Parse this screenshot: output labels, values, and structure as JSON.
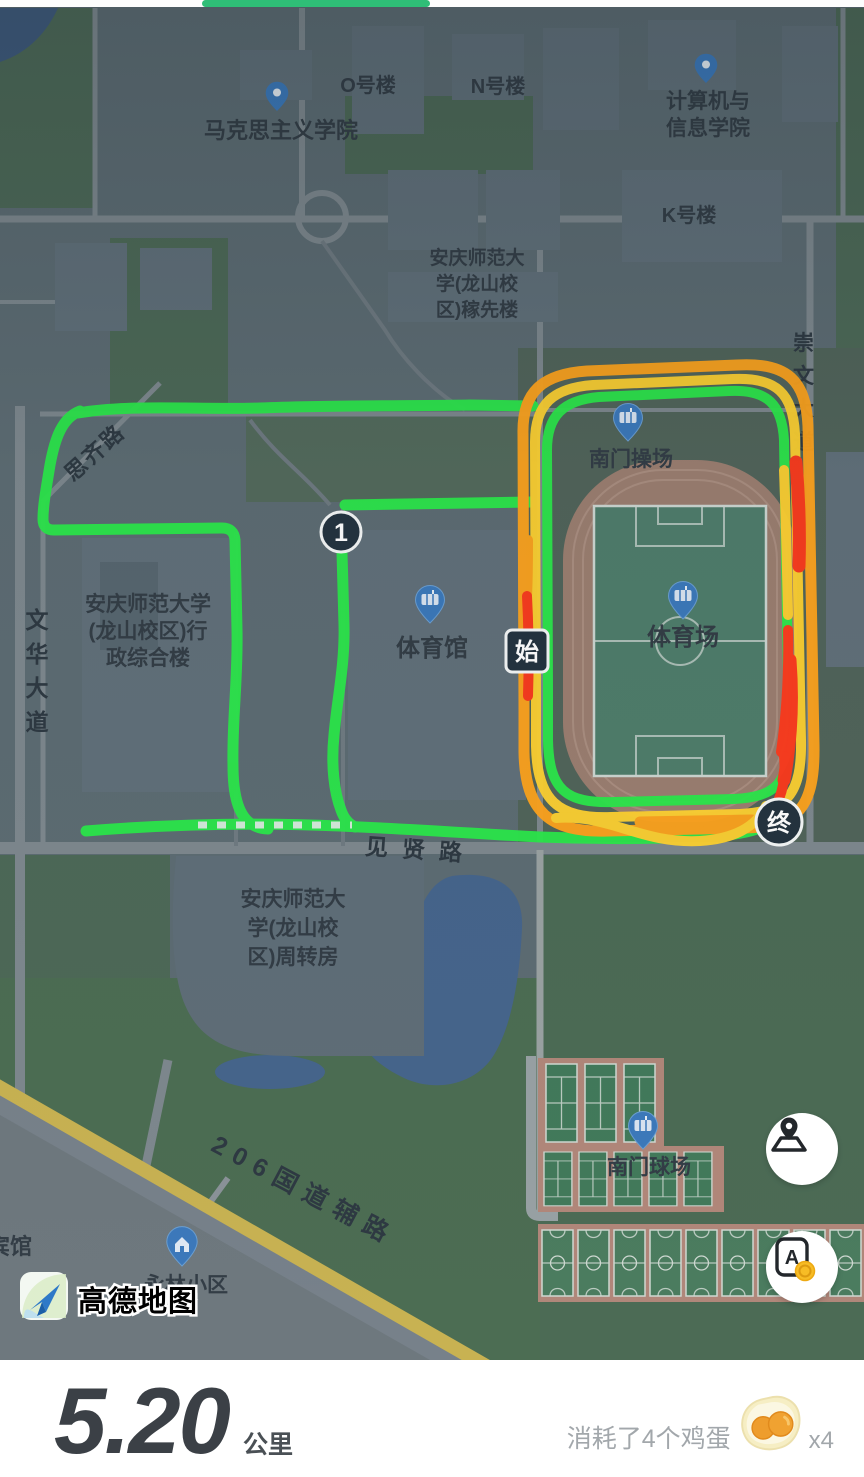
{
  "top_progress": {
    "color": "#2fbe77"
  },
  "map": {
    "labels": {
      "o_building": "O号楼",
      "n_building": "N号楼",
      "k_building": "K号楼",
      "marxism_school": "马克思主义学院",
      "cs_school_line1": "计算机与",
      "cs_school_line2": "信息学院",
      "jiaxian_line1": "安庆师范大",
      "jiaxian_line2": "学(龙山校",
      "jiaxian_line3": "区)稼先楼",
      "admin_line1": "安庆师范大学",
      "admin_line2": "(龙山校区)行",
      "admin_line3": "政综合楼",
      "gym": "体育馆",
      "stadium": "体育场",
      "south_gate_playground": "南门操场",
      "zhouzhuan_line1": "安庆师范大",
      "zhouzhuan_line2": "学(龙山校",
      "zhouzhuan_line3": "区)周转房",
      "south_gate_courts": "南门球场",
      "yonglin": "永林小区",
      "hotel": "宾馆"
    },
    "roads": {
      "wenhua_avenue": "文华大道",
      "chongwen_avenue": "崇文大道",
      "siqi_road": "思齐路",
      "jianxian_road": "见贤路",
      "g206": "206国道辅路"
    },
    "markers": {
      "km1": "1",
      "start": "始",
      "end": "终"
    },
    "logo_text": "高德地图",
    "route_colors": {
      "fast": "#2ce84b",
      "medium": "#ffd231",
      "slow": "#ffa41d",
      "slowest": "#ff3a1c"
    }
  },
  "controls": {
    "translate_letter": "A"
  },
  "stats": {
    "distance": "5.20",
    "unit": "公里",
    "calorie_note": "消耗了4个鸡蛋",
    "egg_multiplier": "x4"
  }
}
